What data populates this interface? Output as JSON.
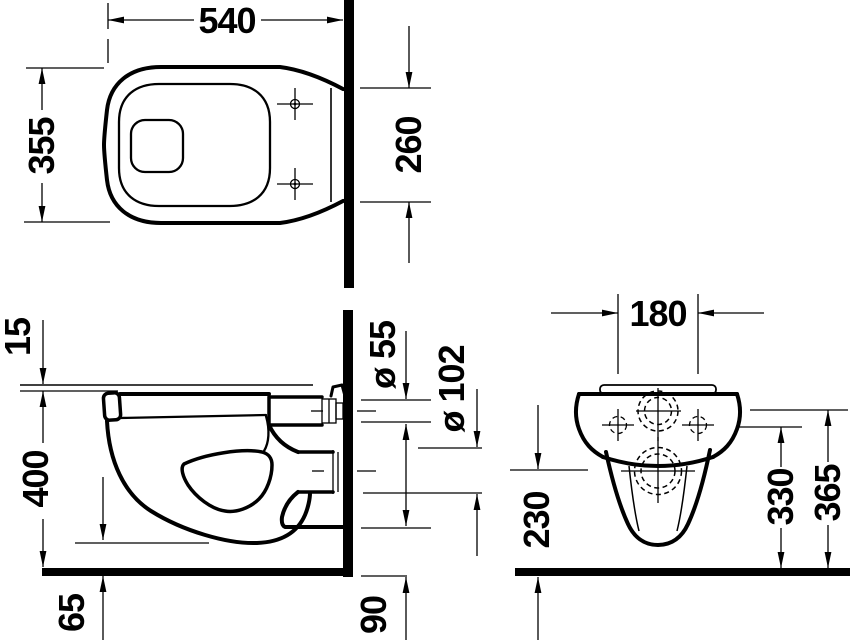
{
  "colors": {
    "ink": "#000000",
    "paper": "#ffffff"
  },
  "views": {
    "plan": {
      "width": "540",
      "depth": "355",
      "wall_width": "260"
    },
    "side": {
      "seat_offset": "15",
      "rim_height": "400",
      "bottom_clearance": "65",
      "inlet_diameter": "ø 55",
      "outlet_diameter": "ø 102",
      "outlet_bottom_height": "90"
    },
    "front": {
      "fixing_hole_spacing": "180",
      "outlet_center_height": "230",
      "fixing_hole_height": "330",
      "inlet_center_height": "365"
    }
  }
}
